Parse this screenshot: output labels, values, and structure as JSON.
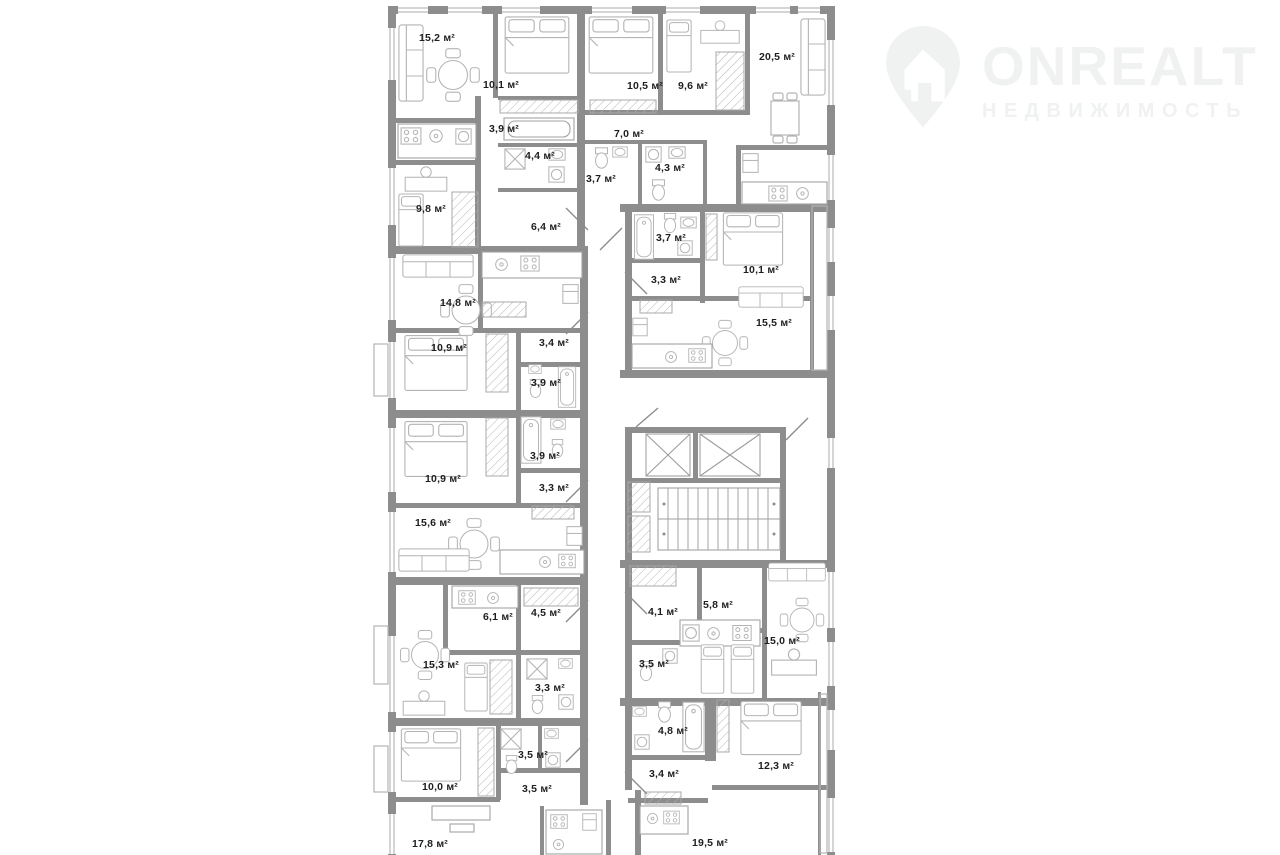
{
  "brand": {
    "name": "ONREALT",
    "tagline": "НЕДВИЖИМОСТЬ"
  },
  "colors": {
    "walls": "#8d8d8d",
    "label_text": "#1e1e1e",
    "logo": "#f0f1f1"
  },
  "floor_plan": {
    "unit": "м²",
    "rooms": [
      {
        "label": "15,2",
        "x": 437,
        "y": 38
      },
      {
        "label": "10,1",
        "x": 501,
        "y": 85
      },
      {
        "label": "10,5",
        "x": 645,
        "y": 86
      },
      {
        "label": "9,6",
        "x": 693,
        "y": 86
      },
      {
        "label": "20,5",
        "x": 777,
        "y": 57
      },
      {
        "label": "3,9",
        "x": 504,
        "y": 129
      },
      {
        "label": "4,4",
        "x": 540,
        "y": 156
      },
      {
        "label": "7,0",
        "x": 629,
        "y": 134
      },
      {
        "label": "3,7",
        "x": 601,
        "y": 179
      },
      {
        "label": "4,3",
        "x": 670,
        "y": 168
      },
      {
        "label": "9,8",
        "x": 431,
        "y": 209
      },
      {
        "label": "6,4",
        "x": 546,
        "y": 227
      },
      {
        "label": "3,7",
        "x": 671,
        "y": 238
      },
      {
        "label": "3,3",
        "x": 666,
        "y": 280
      },
      {
        "label": "10,1",
        "x": 761,
        "y": 270
      },
      {
        "label": "15,5",
        "x": 774,
        "y": 323
      },
      {
        "label": "14,8",
        "x": 458,
        "y": 303
      },
      {
        "label": "10,9",
        "x": 449,
        "y": 348
      },
      {
        "label": "3,4",
        "x": 554,
        "y": 343
      },
      {
        "label": "3,9",
        "x": 546,
        "y": 383
      },
      {
        "label": "3,9",
        "x": 545,
        "y": 456
      },
      {
        "label": "10,9",
        "x": 443,
        "y": 479
      },
      {
        "label": "3,3",
        "x": 554,
        "y": 488
      },
      {
        "label": "15,6",
        "x": 433,
        "y": 523
      },
      {
        "label": "6,1",
        "x": 498,
        "y": 617
      },
      {
        "label": "4,5",
        "x": 546,
        "y": 613
      },
      {
        "label": "15,3",
        "x": 441,
        "y": 665
      },
      {
        "label": "3,3",
        "x": 550,
        "y": 688
      },
      {
        "label": "4,1",
        "x": 663,
        "y": 612
      },
      {
        "label": "5,8",
        "x": 718,
        "y": 605
      },
      {
        "label": "3,5",
        "x": 654,
        "y": 664
      },
      {
        "label": "15,0",
        "x": 782,
        "y": 641
      },
      {
        "label": "4,8",
        "x": 673,
        "y": 731
      },
      {
        "label": "3,4",
        "x": 664,
        "y": 774
      },
      {
        "label": "12,3",
        "x": 776,
        "y": 766
      },
      {
        "label": "3,5",
        "x": 533,
        "y": 755
      },
      {
        "label": "10,0",
        "x": 440,
        "y": 787
      },
      {
        "label": "3,5",
        "x": 537,
        "y": 789
      },
      {
        "label": "17,8",
        "x": 430,
        "y": 844
      },
      {
        "label": "19,5",
        "x": 710,
        "y": 843
      }
    ]
  }
}
